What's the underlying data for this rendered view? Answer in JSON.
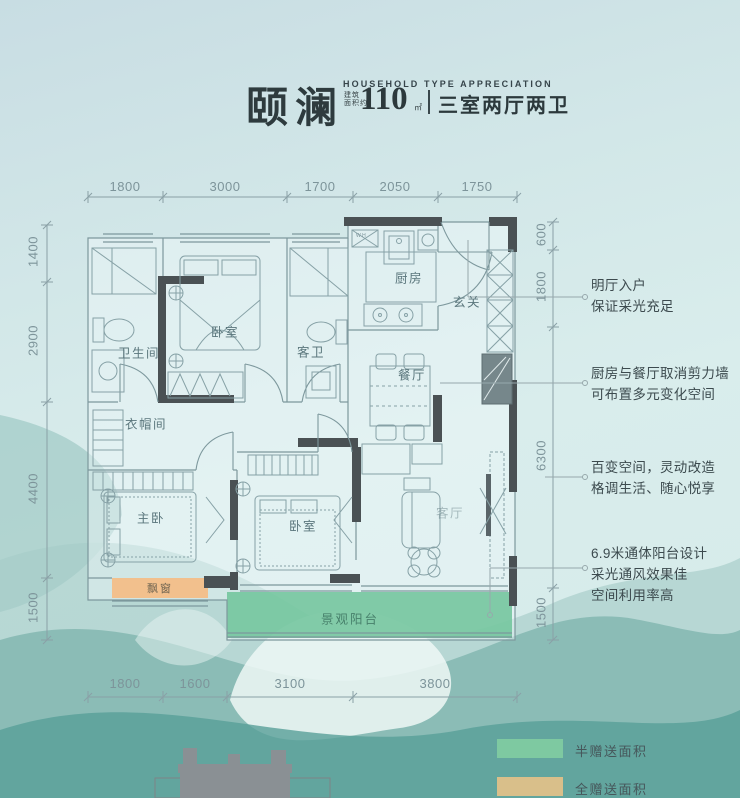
{
  "header": {
    "brand": "颐澜",
    "subtitle_en": "HOUSEHOLD TYPE APPRECIATION",
    "area_prefix_line1": "建筑",
    "area_prefix_line2": "面积约",
    "area_value": "110",
    "area_unit": "㎡",
    "layout": "三室两厅两卫"
  },
  "dimensions": {
    "top": [
      "1800",
      "3000",
      "1700",
      "2050",
      "1750"
    ],
    "left": [
      "1400",
      "2900",
      "4400",
      "1500"
    ],
    "right": [
      "600",
      "1800",
      "6300",
      "1500"
    ],
    "bottom": [
      "1800",
      "1600",
      "3100",
      "3800"
    ]
  },
  "rooms": {
    "bathroom": "卫生间",
    "bedroom_top": "卧室",
    "guest_bath": "客卫",
    "kitchen": "厨房",
    "foyer": "玄关",
    "dining": "餐厅",
    "cloakroom": "衣帽间",
    "master": "主卧",
    "bedroom_bottom": "卧室",
    "living": "客厅",
    "bay_window": "飘窗",
    "balcony": "景观阳台"
  },
  "plan_labels": {
    "appliance": "W H"
  },
  "annotations": [
    {
      "lines": [
        "明厅入户",
        "保证采光充足"
      ]
    },
    {
      "lines": [
        "厨房与餐厅取消剪力墙",
        "可布置多元变化空间"
      ]
    },
    {
      "lines": [
        "百变空间，灵动改造",
        "格调生活、随心悦享"
      ]
    },
    {
      "lines": [
        "6.9米通体阳台设计",
        "采光通风效果佳",
        "空间利用率高"
      ]
    }
  ],
  "legend": [
    {
      "label": "半赠送面积",
      "color": "#7ec9a1"
    },
    {
      "label": "全赠送面积",
      "color": "#d9bf8a"
    }
  ],
  "colors": {
    "balcony_fill": "#6fc39a",
    "bay_window_fill": "#f2c08d",
    "wall": "#4a5154",
    "plan_line": "#7d989d",
    "title_text": "#2e3b3e"
  }
}
